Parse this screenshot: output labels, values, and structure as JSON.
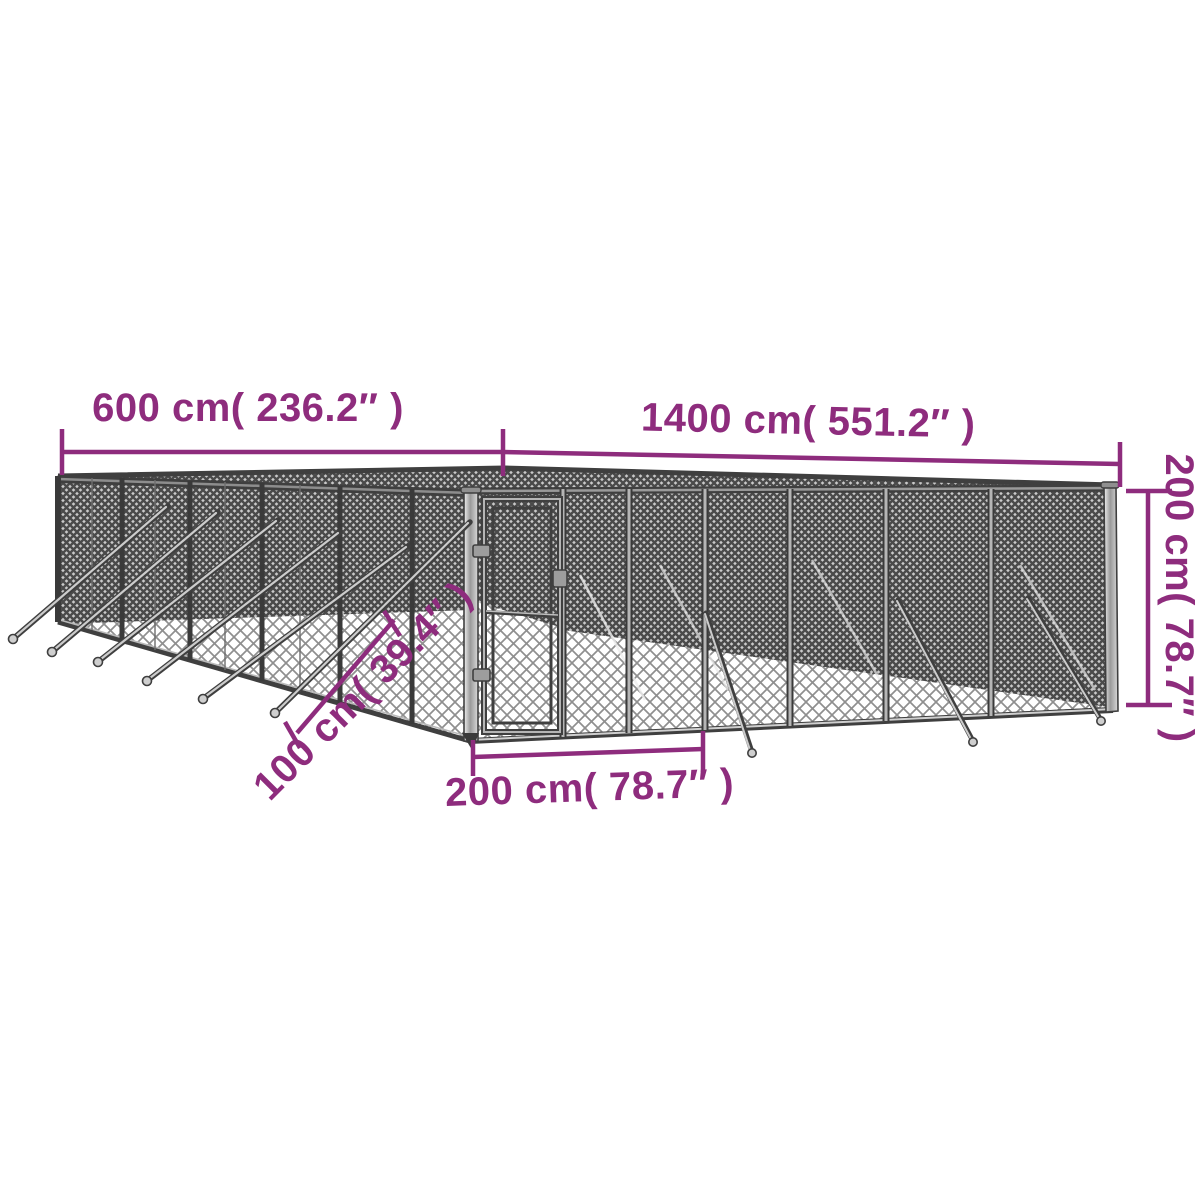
{
  "diagram": {
    "type": "product-dimension-diagram",
    "subject": "outdoor chain-link dog kennel with gate",
    "colors": {
      "dimension_magenta": "#8E2C7D",
      "frame_dark": "#3F3F3F",
      "frame_gray": "#B5B5B5",
      "background": "#FFFFFF"
    },
    "dimensions": [
      {
        "id": "depth",
        "label": "600 cm( 236.2″ )",
        "value_cm": 600,
        "value_inch": 236.2,
        "position": "top-left"
      },
      {
        "id": "length",
        "label": "1400 cm( 551.2″ )",
        "value_cm": 1400,
        "value_inch": 551.2,
        "position": "top-right"
      },
      {
        "id": "height",
        "label": "200 cm( 78.7″ )",
        "value_cm": 200,
        "value_inch": 78.7,
        "position": "right-vertical"
      },
      {
        "id": "stake",
        "label": "100 cm( 39.4″ )",
        "value_cm": 100,
        "value_inch": 39.4,
        "position": "diagonal-lower-left"
      },
      {
        "id": "gate_width",
        "label": "200 cm( 78.7″ )",
        "value_cm": 200,
        "value_inch": 78.7,
        "position": "bottom-center"
      }
    ]
  }
}
